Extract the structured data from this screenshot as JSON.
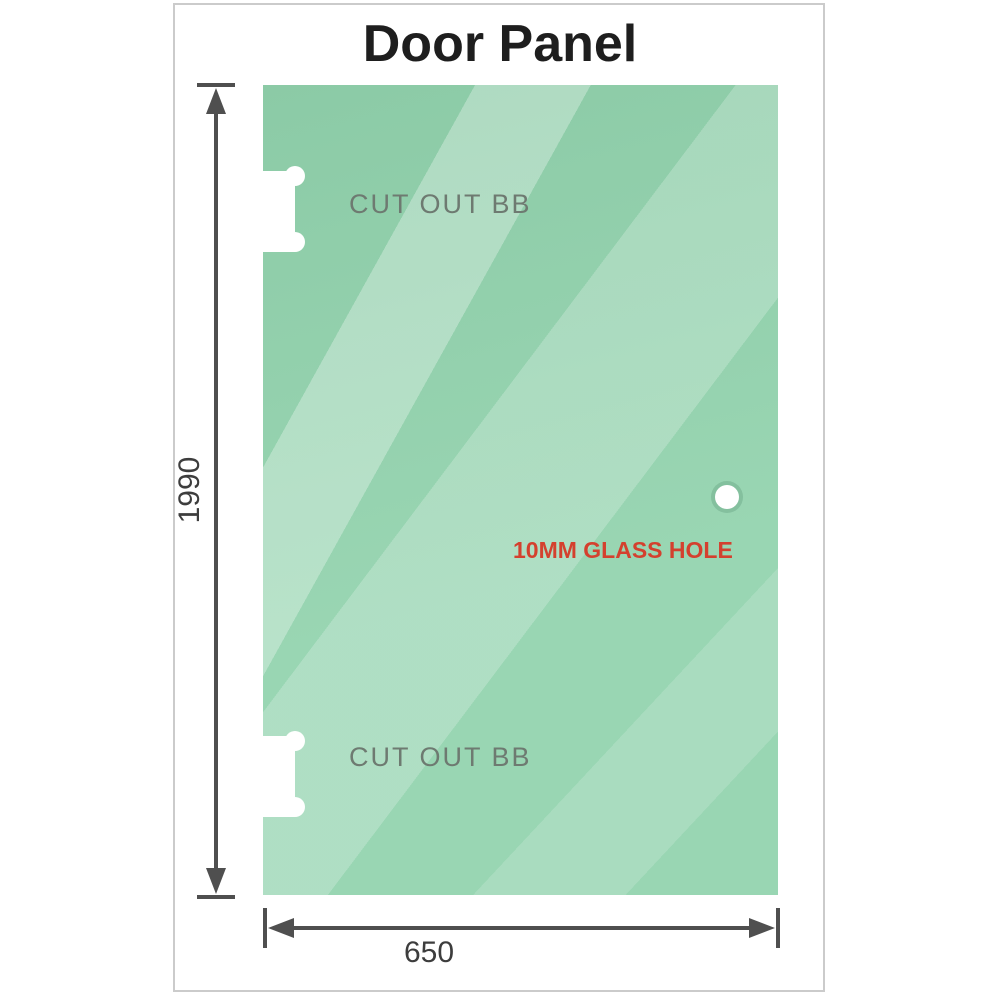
{
  "title": "Door Panel",
  "panel": {
    "cutout_top_label": "CUT OUT BB",
    "cutout_bottom_label": "CUT OUT BB",
    "hole_label": "10MM GLASS HOLE"
  },
  "dimensions": {
    "height_label": "1990",
    "width_label": "650"
  },
  "colors": {
    "glass_base": "#93d3ae",
    "glass_highlight": "#bfe7cf",
    "frame_border": "#cbcbcb",
    "title": "#1e1e1e",
    "dimension": "#4f4f4f",
    "dimension_text": "#3d3d3d",
    "cutout_label": "#6e7a71",
    "hole_label": "#d4402e"
  }
}
